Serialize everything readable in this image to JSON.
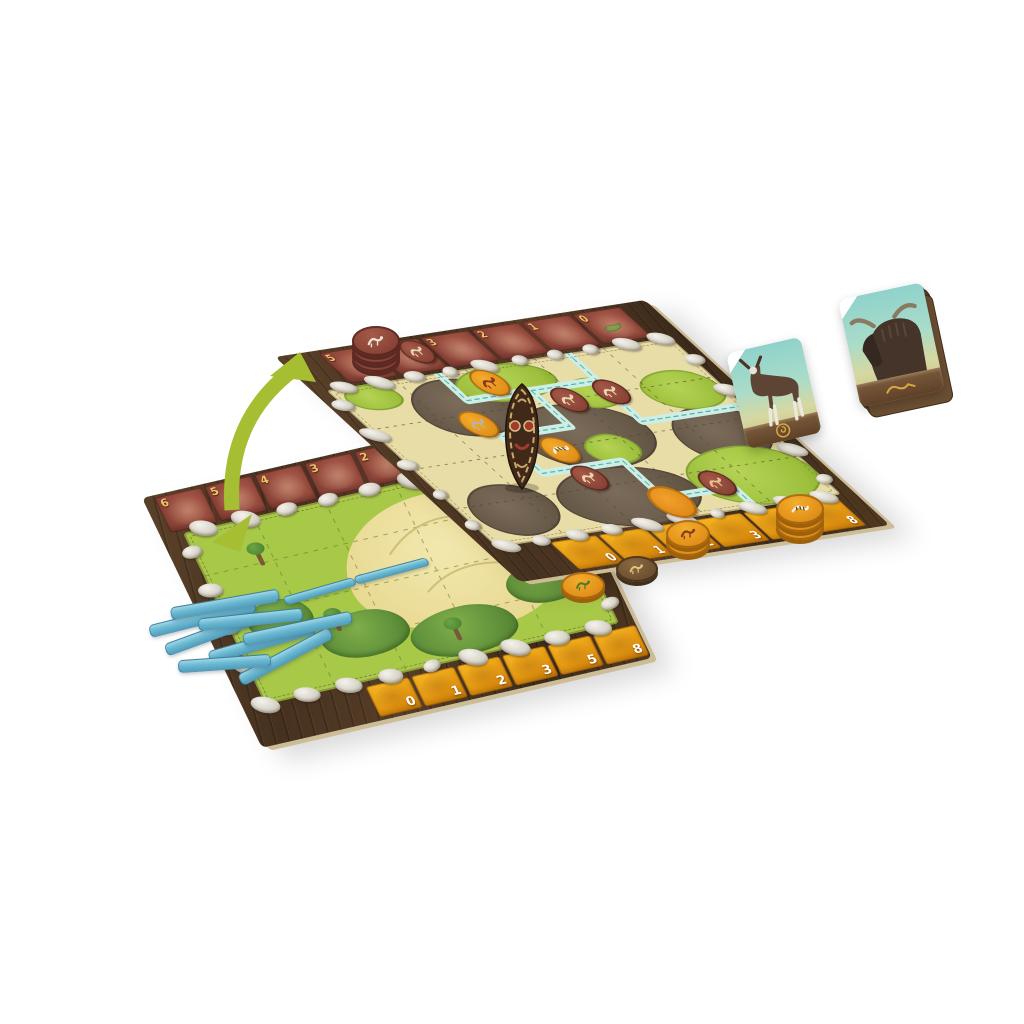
{
  "scene": {
    "background_color": "#ffffff",
    "subject": "board game components: double-sided game board, animal tokens, cards and blue sticks"
  },
  "back_board": {
    "red_track": {
      "numbers": [
        "5",
        "4",
        "3",
        "2",
        "1",
        "0"
      ],
      "tile_color": "#94493c",
      "number_color": "#ecc468",
      "end_icon": "crocodile-icon"
    },
    "score_track": {
      "numbers": [
        "0",
        "1",
        "2",
        "3",
        "5",
        "8"
      ],
      "tile_color": "#e1930f",
      "number_color": "#ffffff"
    },
    "terrain_colors": {
      "meadow": "#9dbf3c",
      "sand": "#e7d88f",
      "soil": "#665847",
      "river_fill": "#cdeee6",
      "river_dash": "#55b6a3",
      "stone": "#d8d4c9",
      "wood": "#46311f",
      "parchment": "#e8dda6"
    }
  },
  "front_board": {
    "red_track": {
      "numbers": [
        "6",
        "5",
        "4",
        "3",
        "2",
        "1"
      ]
    },
    "score_track": {
      "numbers": [
        "0",
        "1",
        "2",
        "3",
        "5",
        "8"
      ]
    }
  },
  "tokens": {
    "board_tokens": [
      {
        "id": "token-horse-1",
        "animal": "horse",
        "base": "maroon",
        "glyph": "#e9d6b0"
      },
      {
        "id": "token-tiger-1",
        "animal": "tiger",
        "base": "orange",
        "glyph": "#8a3a22"
      },
      {
        "id": "token-elephant",
        "animal": "elephant",
        "base": "orange",
        "glyph": "#b9b3a6"
      },
      {
        "id": "token-horse-2",
        "animal": "horse",
        "base": "maroon",
        "glyph": "#e9d6b0"
      },
      {
        "id": "token-horse-3",
        "animal": "horse",
        "base": "maroon",
        "glyph": "#e9d6b0"
      },
      {
        "id": "token-zebra-1",
        "animal": "zebra",
        "base": "orange",
        "glyph": "#f2efe8",
        "stripes": true
      },
      {
        "id": "token-deer",
        "animal": "deer",
        "base": "maroon",
        "glyph": "#e9d6b0"
      },
      {
        "id": "token-tiger-2",
        "animal": "tiger",
        "base": "maroon",
        "glyph": "#e9c08a"
      },
      {
        "id": "token-orange-disc",
        "animal": "none",
        "base": "disc"
      }
    ],
    "stacks": [
      {
        "id": "stack-maroon",
        "animal": "antelope",
        "base": "maroon",
        "count": 3,
        "glyph": "#e9e3da"
      },
      {
        "id": "stack-tiger",
        "animal": "tiger",
        "base": "orange",
        "count": 2,
        "glyph": "#8a3a22"
      },
      {
        "id": "token-lion-flat",
        "animal": "lion",
        "base": "brown",
        "count": 1,
        "glyph": "#e3c27a"
      },
      {
        "id": "stack-zebra",
        "animal": "zebra",
        "base": "orange",
        "count": 3,
        "glyph": "#f4f1ea",
        "stripes": true
      },
      {
        "id": "token-croc-flat",
        "animal": "crocodile",
        "base": "orange",
        "count": 1,
        "glyph": "#4e7a28"
      }
    ]
  },
  "cards": {
    "single_card": {
      "animal": "okapi",
      "sky_color": "#8fd2cb",
      "bar_color": "#5d4128",
      "emblem": "coin-icon"
    },
    "card_stack": {
      "animal": "wildebeest",
      "visible_edges": 6
    }
  },
  "sticks": {
    "pile_count": 8,
    "on_board_count": 2,
    "color": "#6db9d3"
  },
  "arrow": {
    "name": "flip-arrow",
    "color": "#a6bf32",
    "double_headed": true
  }
}
